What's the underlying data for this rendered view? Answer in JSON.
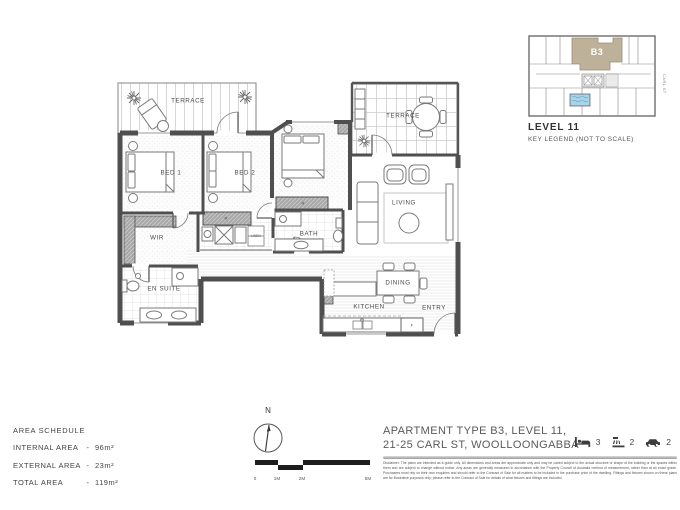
{
  "palette": {
    "highlight_tan": "#BDB199",
    "wall_gray": "#4F4F4F",
    "pool_blue": "#A8D4EA"
  },
  "plan": {
    "rooms": {
      "terrace": "TERRACE",
      "bed1": "BED 1",
      "bed2": "BED 2",
      "wir": "WIR",
      "ensuite": "EN SUITE",
      "bath": "BATH",
      "linen": "LINEN",
      "living": "LIVING",
      "dining": "DINING",
      "kitchen": "KITCHEN",
      "entry": "ENTRY",
      "robe": "R",
      "fridge": "F"
    }
  },
  "key_legend": {
    "unit_label": "B3",
    "level_title": "LEVEL 11",
    "subtitle": "KEY LEGEND (NOT TO SCALE)",
    "street_label": "CARL ST"
  },
  "area_schedule": {
    "title": "AREA SCHEDULE",
    "rows": [
      {
        "label": "INTERNAL AREA",
        "sep": "-",
        "value": "96m²"
      },
      {
        "label": "EXTERNAL AREA",
        "sep": "-",
        "value": "23m²"
      },
      {
        "label": "TOTAL AREA",
        "sep": "-",
        "value": "119m²"
      }
    ]
  },
  "compass": {
    "north_label": "N"
  },
  "scale_bar": {
    "labels": [
      "0",
      "1M",
      "2M",
      "5M"
    ]
  },
  "title_block": {
    "line1": "APARTMENT TYPE B3, LEVEL 11,",
    "line2": "21-25 CARL ST, WOOLLOONGABBA",
    "features": [
      {
        "icon": "bed-icon",
        "count": "3"
      },
      {
        "icon": "bath-icon",
        "count": "2"
      },
      {
        "icon": "car-icon",
        "count": "2"
      }
    ],
    "disclaimer": "Disclaimer: The plans are intended as a guide only. All dimensions and areas are approximate only and may be varied subject to the actual structure or shape of the building or the spaces within them and are subject to change without notice. Any areas are generally measured in accordance with the Property Council of Australia method of measurement, rather than at an exact grade. Purchasers must rely on their own enquiries and should refer to the Contract of Sale for all matters to be included in the purchase price of the dwelling. Fittings and fixtures shown on these plans are for illustrative purposes only; please refer to the Contract of Sale for details of what fixtures and fittings are included."
  }
}
